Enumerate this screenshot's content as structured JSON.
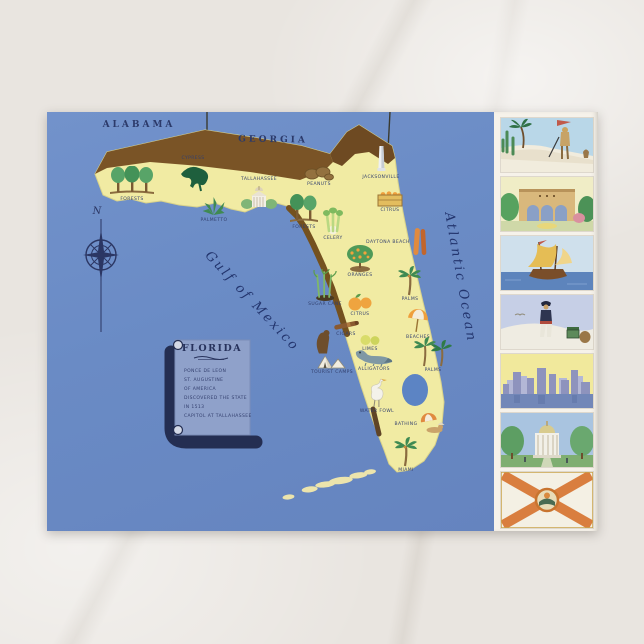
{
  "postcard": {
    "type": "vintage illustrated map postcard of Florida",
    "region_labels": {
      "alabama": "ALABAMA",
      "georgia": "GEORGIA"
    },
    "water_labels": {
      "gulf": "Gulf of Mexico",
      "atlantic": "Atlantic Ocean"
    },
    "compass": {
      "north": "N"
    },
    "legend_scroll": {
      "title": "FLORIDA",
      "lines": [
        "PONCE DE LEON",
        "ST. AUGUSTINE",
        "OF AMERICA",
        "DISCOVERED THE STATE",
        "IN 1513",
        "CAPITOL AT TALLAHASSEE"
      ]
    },
    "map_items": [
      {
        "type": "pines3",
        "x": 85,
        "y": 72,
        "label": "FORESTS"
      },
      {
        "type": "cypress",
        "x": 146,
        "y": 62,
        "label": "CYPRESS",
        "label_pos": "above"
      },
      {
        "type": "palmetto",
        "x": 167,
        "y": 97,
        "label": "PALMETTO"
      },
      {
        "type": "capitol",
        "x": 212,
        "y": 82,
        "label": "TALLAHASSEE",
        "label_pos": "above"
      },
      {
        "type": "pines2",
        "x": 257,
        "y": 100,
        "label": "FORESTS"
      },
      {
        "type": "peanuts",
        "x": 272,
        "y": 64,
        "label": "PEANUTS"
      },
      {
        "type": "monument",
        "x": 334,
        "y": 50,
        "label": "JACKSONVILLE"
      },
      {
        "type": "crate",
        "x": 343,
        "y": 90,
        "label": "CITRUS"
      },
      {
        "type": "celery",
        "x": 286,
        "y": 112,
        "label": "CELERY"
      },
      {
        "type": "surfboards",
        "x": 350,
        "y": 130,
        "label": "DAYTONA BEACH",
        "label_pos": "left"
      },
      {
        "type": "orange-tree",
        "x": 313,
        "y": 149,
        "label": "ORANGES"
      },
      {
        "type": "sugarcane",
        "x": 278,
        "y": 176,
        "label": "SUGAR CANE"
      },
      {
        "type": "oranges",
        "x": 313,
        "y": 193,
        "label": "CITRUS"
      },
      {
        "type": "palm1",
        "x": 363,
        "y": 172,
        "label": "PALMS"
      },
      {
        "type": "cigar",
        "x": 299,
        "y": 216,
        "label": "CIGARS"
      },
      {
        "type": "limes",
        "x": 323,
        "y": 231,
        "label": "LIMES"
      },
      {
        "type": "umbrella",
        "x": 371,
        "y": 212,
        "label": "BEACHES"
      },
      {
        "type": "bear",
        "x": 276,
        "y": 230,
        "label": ""
      },
      {
        "type": "tent",
        "x": 285,
        "y": 252,
        "label": "TOURIST CAMPS"
      },
      {
        "type": "alligator",
        "x": 327,
        "y": 248,
        "label": "ALLIGATORS"
      },
      {
        "type": "palms2",
        "x": 386,
        "y": 242,
        "label": "PALMS"
      },
      {
        "type": "egret",
        "x": 330,
        "y": 284,
        "label": "WATER FOWL"
      },
      {
        "type": "sunbather",
        "x": 373,
        "y": 312,
        "label": "BATHING",
        "label_pos": "left"
      },
      {
        "type": "palm1",
        "x": 359,
        "y": 343,
        "label": "MIAMI"
      }
    ],
    "vignettes": [
      {
        "name": "conquistador-landing"
      },
      {
        "name": "spanish-mission"
      },
      {
        "name": "spanish-galleon"
      },
      {
        "name": "pirate-with-treasure"
      },
      {
        "name": "miami-skyline"
      },
      {
        "name": "state-capitol"
      },
      {
        "name": "florida-state-flag"
      }
    ],
    "colors": {
      "sea_blue": "#6a8bc5",
      "state_yellow": "#f1eba3",
      "border_brown": "#7a5426",
      "ink_navy": "#2b3a66",
      "scroll_blue": "#8fa1ca",
      "flag_cross_orange": "#d97e3f",
      "card_white": "#f6f2ea"
    }
  }
}
